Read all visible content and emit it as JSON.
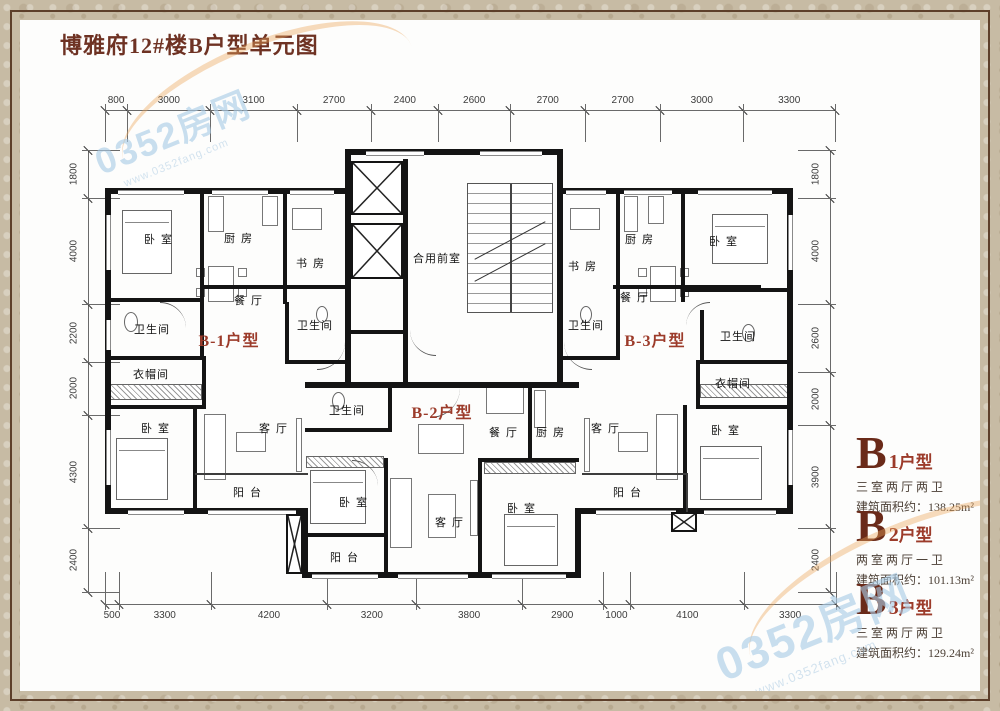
{
  "title": "博雅府12#楼B户型单元图",
  "watermark": {
    "brand": "0352房网",
    "url": "www.0352fang.com"
  },
  "dimensions": {
    "top": [
      800,
      3000,
      3100,
      2700,
      2400,
      2600,
      2700,
      2700,
      3000,
      3300
    ],
    "bottom": [
      500,
      3300,
      4200,
      3200,
      3800,
      2900,
      1000,
      4100,
      3300
    ],
    "left": [
      1800,
      4000,
      2200,
      2000,
      4300,
      2400
    ],
    "right": [
      1800,
      4000,
      2600,
      2000,
      3900,
      2400
    ]
  },
  "unit_labels": [
    {
      "label": "B-1户型",
      "x": 229,
      "y": 339
    },
    {
      "label": "B-2户型",
      "x": 442,
      "y": 411
    },
    {
      "label": "B-3户型",
      "x": 655,
      "y": 339
    }
  ],
  "rooms": [
    {
      "label": "卧室",
      "x": 161,
      "y": 239
    },
    {
      "label": "厨房",
      "x": 241,
      "y": 238
    },
    {
      "label": "书房",
      "x": 313,
      "y": 263
    },
    {
      "label": "餐厅",
      "x": 251,
      "y": 300
    },
    {
      "label": "卫生间",
      "x": 152,
      "y": 329
    },
    {
      "label": "卫生间",
      "x": 315,
      "y": 325
    },
    {
      "label": "衣帽间",
      "x": 151,
      "y": 374
    },
    {
      "label": "卧室",
      "x": 158,
      "y": 428
    },
    {
      "label": "客厅",
      "x": 276,
      "y": 428
    },
    {
      "label": "阳台",
      "x": 250,
      "y": 492
    },
    {
      "label": "卫生间",
      "x": 347,
      "y": 410
    },
    {
      "label": "餐厅",
      "x": 506,
      "y": 432
    },
    {
      "label": "厨房",
      "x": 553,
      "y": 432
    },
    {
      "label": "卧室",
      "x": 356,
      "y": 502
    },
    {
      "label": "客厅",
      "x": 452,
      "y": 522
    },
    {
      "label": "卧室",
      "x": 524,
      "y": 508
    },
    {
      "label": "阳台",
      "x": 347,
      "y": 557
    },
    {
      "label": "书房",
      "x": 585,
      "y": 266
    },
    {
      "label": "厨房",
      "x": 642,
      "y": 239
    },
    {
      "label": "卧室",
      "x": 726,
      "y": 241
    },
    {
      "label": "餐厅",
      "x": 637,
      "y": 297
    },
    {
      "label": "卫生间",
      "x": 586,
      "y": 325
    },
    {
      "label": "卫生间",
      "x": 738,
      "y": 336
    },
    {
      "label": "衣帽间",
      "x": 733,
      "y": 383
    },
    {
      "label": "卧室",
      "x": 728,
      "y": 430
    },
    {
      "label": "客厅",
      "x": 608,
      "y": 428
    },
    {
      "label": "阳台",
      "x": 630,
      "y": 492
    },
    {
      "label": "合用前室",
      "x": 437,
      "y": 258
    }
  ],
  "info_panel": [
    {
      "letter": "B",
      "number": "1",
      "suffix": "户型",
      "layout": "三室两厅两卫",
      "area": "建筑面积约：138.25m²"
    },
    {
      "letter": "B",
      "number": "2",
      "suffix": "户型",
      "layout": "两室两厅一卫",
      "area": "建筑面积约：101.13m²"
    },
    {
      "letter": "B",
      "number": "3",
      "suffix": "户型",
      "layout": "三室两厅两卫",
      "area": "建筑面积约：129.24m²"
    }
  ],
  "colors": {
    "accent": "#9c3b2a",
    "title": "#6e3223",
    "wall": "#141414",
    "frame": "#c7bba4",
    "watermark_blue": "#a9cce6",
    "swoosh_orange": "#eda55a"
  }
}
